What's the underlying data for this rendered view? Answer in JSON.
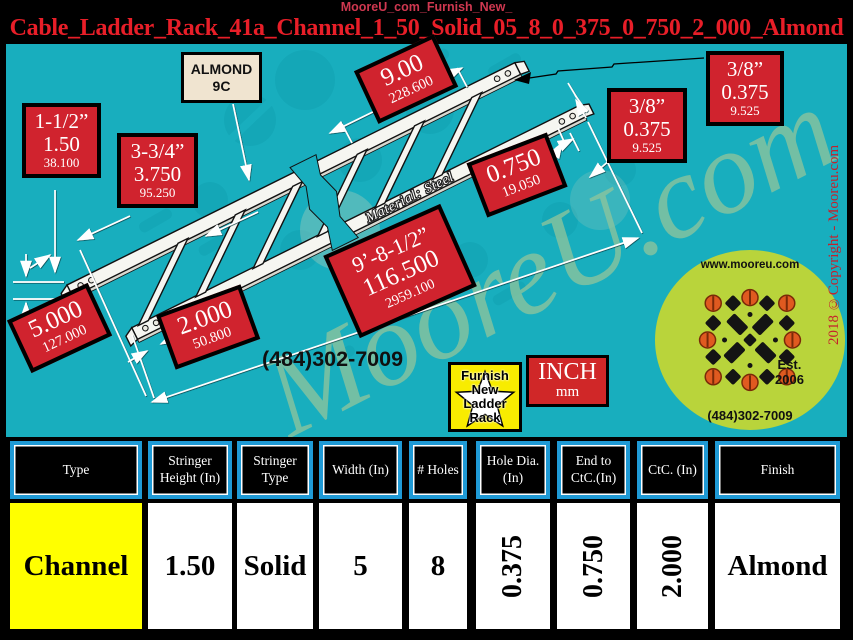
{
  "header": {
    "site_line": "MooreU_com_Furnish_New_",
    "title": "Cable_Ladder_Rack_41a_Channel_1_50_Solid_05_8_0_375_0_750_2_000_Almond"
  },
  "colors": {
    "background_teal": "#18aebe",
    "label_red": "#d0232e",
    "title_red": "#e81e28",
    "table_border_blue": "#1f9ad6",
    "highlight_yellow": "#ffff00",
    "logo_green": "#b9d43b",
    "sign_yellow": "#f8ec00",
    "almond_cream": "#f0e4d0"
  },
  "diagram": {
    "almond_chip": {
      "line1": "ALMOND",
      "line2": "9C"
    },
    "material_note": "Material: Steel",
    "phone": "(484)302-7009",
    "watermark": "MooreU.com",
    "copyright_vertical": "2018 ©Copyright - Mooreu.com",
    "inch_box": {
      "primary": "INCH",
      "secondary": "mm"
    },
    "sign": {
      "lines": [
        "Furnish",
        "New",
        "Ladder",
        "Rack"
      ]
    },
    "logo_badge": {
      "url": "www.mooreu.com",
      "est": "Est.",
      "est_year": "2006",
      "phone": "(484)302-7009"
    },
    "dim_labels": [
      {
        "id": "stringer-height",
        "lines": [
          "1-1/2”",
          "1.50",
          "38.100"
        ]
      },
      {
        "id": "side-rail-width",
        "lines": [
          "3-3/4”",
          "3.750",
          "95.250"
        ]
      },
      {
        "id": "rung-spacing",
        "lines": [
          "9.00",
          "228.600"
        ]
      },
      {
        "id": "end-to-first-hole",
        "lines": [
          "0.750",
          "19.050"
        ]
      },
      {
        "id": "hole-diameter-a",
        "lines": [
          "3/8”",
          "0.375",
          "9.525"
        ]
      },
      {
        "id": "hole-diameter-b",
        "lines": [
          "3/8”",
          "0.375",
          "9.525"
        ]
      },
      {
        "id": "rack-width",
        "lines": [
          "5.000",
          "127.000"
        ]
      },
      {
        "id": "hole-ctc",
        "lines": [
          "2.000",
          "50.800"
        ]
      },
      {
        "id": "overall-length",
        "lines": [
          "9’-8-1/2”",
          "116.500",
          "2959.100"
        ]
      }
    ]
  },
  "table": {
    "columns": [
      {
        "header": "Type",
        "value": "Channel",
        "highlight": true,
        "rotated": false
      },
      {
        "header": "Stringer Height (In)",
        "value": "1.50",
        "highlight": false,
        "rotated": false
      },
      {
        "header": "Stringer Type",
        "value": "Solid",
        "highlight": false,
        "rotated": false
      },
      {
        "header": "Width (In)",
        "value": "5",
        "highlight": false,
        "rotated": false
      },
      {
        "header": "# Holes",
        "value": "8",
        "highlight": false,
        "rotated": false
      },
      {
        "header": "Hole Dia. (In)",
        "value": "0.375",
        "highlight": false,
        "rotated": true
      },
      {
        "header": "End to CtC.(In)",
        "value": "0.750",
        "highlight": false,
        "rotated": true
      },
      {
        "header": "CtC. (In)",
        "value": "2.000",
        "highlight": false,
        "rotated": true
      },
      {
        "header": "Finish",
        "value": "Almond",
        "highlight": false,
        "rotated": false
      }
    ]
  }
}
